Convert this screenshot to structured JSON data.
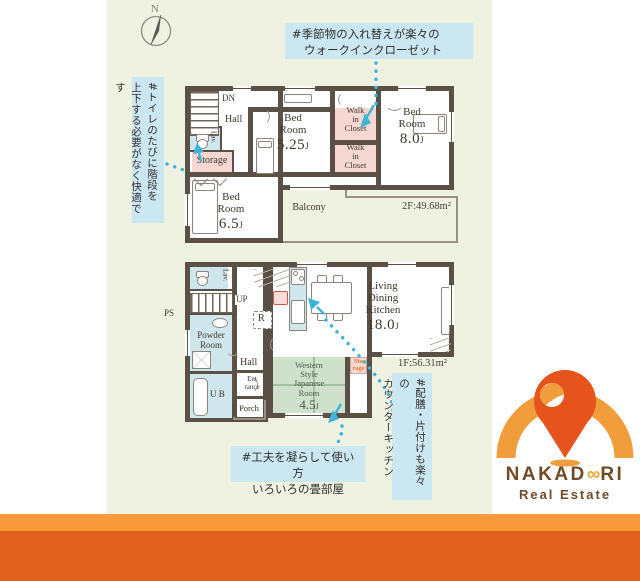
{
  "compass": {
    "label": "N"
  },
  "annotations": {
    "walk_in_closet": {
      "line1": "#季節物の入れ替えが楽々の",
      "line2": "ウォークインクローゼット"
    },
    "toilet_stairs": {
      "line1": "#トイレのたびに階段を",
      "line2": "上下する必要がなく快適です"
    },
    "tatami": {
      "line1": "#工夫を凝らして使い方",
      "line2": "いろいろの畳部屋"
    },
    "counter_kitchen": {
      "line1": "#配膳・片付けも楽々の",
      "line2": "カウンターキッチン"
    }
  },
  "floor2": {
    "area": "2F:49.68m²",
    "stairs": "DN",
    "hall": "Hall",
    "lav": "Lav.",
    "storage": "Storage",
    "bedroom1": {
      "l1": "Bed",
      "l2": "Room",
      "size": "5.25",
      "unit": "J"
    },
    "wic": {
      "l1": "Walk",
      "l2": "in",
      "l3": "Closet"
    },
    "bedroom2": {
      "l1": "Bed",
      "l2": "Room",
      "size": "8.0",
      "unit": "J"
    },
    "bedroom3": {
      "l1": "Bed",
      "l2": "Room",
      "size": "6.5",
      "unit": "J"
    },
    "balcony": "Balcony"
  },
  "floor1": {
    "area": "1F:56.31m²",
    "stairs": "UP",
    "ps": "PS",
    "lav": "Lav.",
    "powder": {
      "l1": "Powder",
      "l2": "Room"
    },
    "ub": "U B",
    "hall": "Hall",
    "entrance": {
      "l1": "Ent",
      "l2": "rance"
    },
    "porch": "Porch",
    "fridge": "R",
    "ldk": {
      "l1": "Living",
      "l2": "Dining",
      "l3": "Kitchen",
      "size": "18.0",
      "unit": "J"
    },
    "japanese": {
      "l1": "Western",
      "l2": "Style",
      "l3": "Japanese",
      "l4": "Room",
      "size": "4.5",
      "unit": "J"
    },
    "storage": {
      "l1": "Sto",
      "l2": "rage"
    }
  },
  "logo": {
    "brand_pre": "NAKAD",
    "brand_mid": "∞",
    "brand_post": "RI",
    "subtitle": "Real Estate"
  },
  "colors": {
    "accent_cyan": "#3fb3d6",
    "wall": "#5b5046",
    "banner_light": "#fb9a3d",
    "banner_dark": "#e2621d",
    "logo_orange": "#f19d3b",
    "logo_red": "#e7531c",
    "logo_brown": "#6f4b27",
    "annotation_bg": "#cbe7f1",
    "plan_bg": "#eff2e1"
  }
}
